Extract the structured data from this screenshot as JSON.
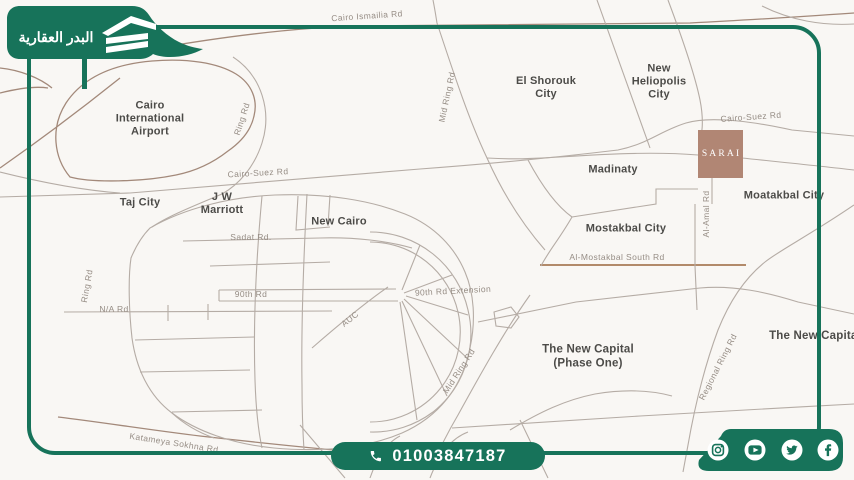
{
  "brand": {
    "name": "البدر العقارية",
    "logo_icon": "building-icon"
  },
  "colors": {
    "accent_green": "#17735A",
    "map_background": "#F9F7F4",
    "road_gray": "#B5ACA5",
    "road_brown": "#A3897A",
    "highlight_brown": "#B18674",
    "city_text": "#4C4B48",
    "road_text": "#968D85"
  },
  "contact": {
    "phone": "01003847187",
    "phone_icon": "phone-icon"
  },
  "social": {
    "icons": [
      "instagram-icon",
      "youtube-icon",
      "twitter-icon",
      "facebook-icon"
    ]
  },
  "map": {
    "highlight": {
      "label": "SARAI"
    },
    "places": [
      {
        "label": "Cairo International Airport"
      },
      {
        "label": "Taj City"
      },
      {
        "label": "J W Marriott"
      },
      {
        "label": "New Cairo"
      },
      {
        "label": "El Shorouk City"
      },
      {
        "label": "New Heliopolis City"
      },
      {
        "label": "Madinaty"
      },
      {
        "label": "Mostakbal City"
      },
      {
        "label": "Moatakbal City"
      },
      {
        "label": "The New Capital (Phase One)"
      },
      {
        "label": "The New Capital"
      }
    ],
    "roads": [
      {
        "label": "Cairo Ismailia Rd"
      },
      {
        "label": "Ring Rd"
      },
      {
        "label": "Cairo-Suez Rd"
      },
      {
        "label": "Cairo-Suez Rd"
      },
      {
        "label": "Mid Ring Rd"
      },
      {
        "label": "Sadat Rd."
      },
      {
        "label": "90th Rd"
      },
      {
        "label": "90th Rd Extension"
      },
      {
        "label": "AUC"
      },
      {
        "label": "N/A Rd"
      },
      {
        "label": "Ring Rd"
      },
      {
        "label": "Mid Ring Rd"
      },
      {
        "label": "Al-Amal Rd"
      },
      {
        "label": "Al-Mostakbal South Rd"
      },
      {
        "label": "Regional Ring Rd"
      },
      {
        "label": "Katameya Sokhna Rd"
      }
    ]
  }
}
